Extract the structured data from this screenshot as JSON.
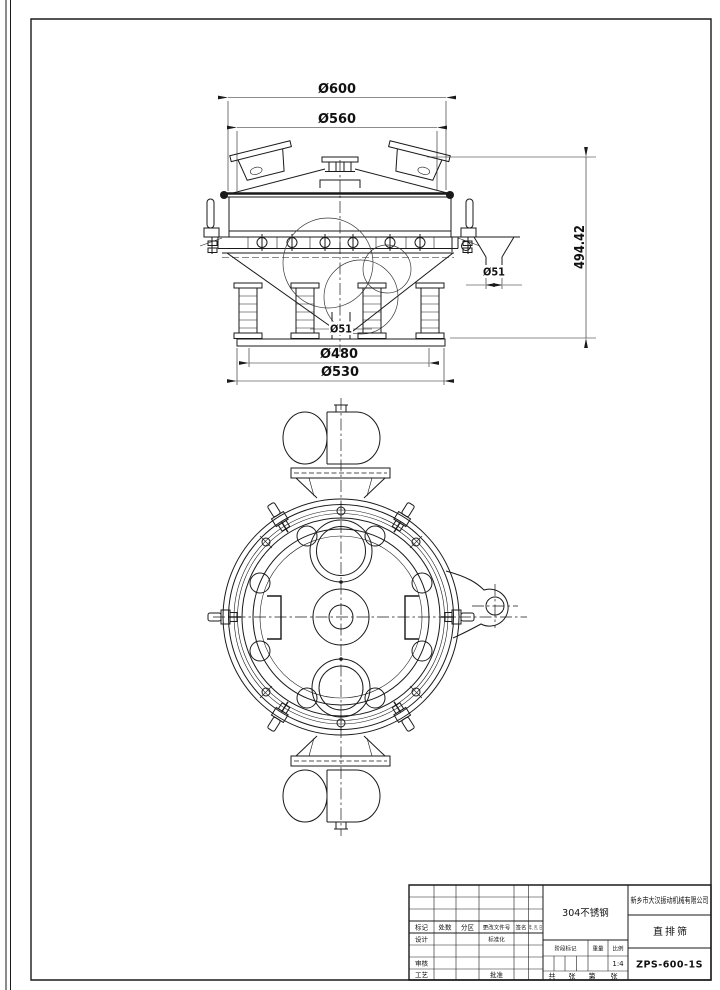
{
  "drawing": {
    "dimensions": {
      "top_outer_diameter": "Ø600",
      "screen_diameter": "Ø560",
      "overall_height": "494.42",
      "side_outlet_diameter": "Ø51",
      "bottom_outlet_diameter": "Ø51",
      "base_bolt_circle": "Ø480",
      "base_diameter": "Ø530"
    }
  },
  "title_block": {
    "company": "新乡市大汉振动机械有限公司",
    "material": "304不锈钢",
    "product_name": "直排筛",
    "drawing_number": "ZPS-600-1S",
    "scale_value": "1:4",
    "labels": {
      "mark": "标记",
      "count": "处数",
      "zone": "分区",
      "change_file_no": "更改文件号",
      "signature": "签名",
      "date": "年、月、日",
      "design": "设计",
      "standardization": "标准化",
      "review": "审核",
      "process": "工艺",
      "approve": "批准",
      "stage_mark": "阶段标记",
      "weight": "重量",
      "scale": "比例",
      "sheet_total": "共",
      "sheet_unit1": "张",
      "sheet_index": "第",
      "sheet_unit2": "张"
    }
  }
}
